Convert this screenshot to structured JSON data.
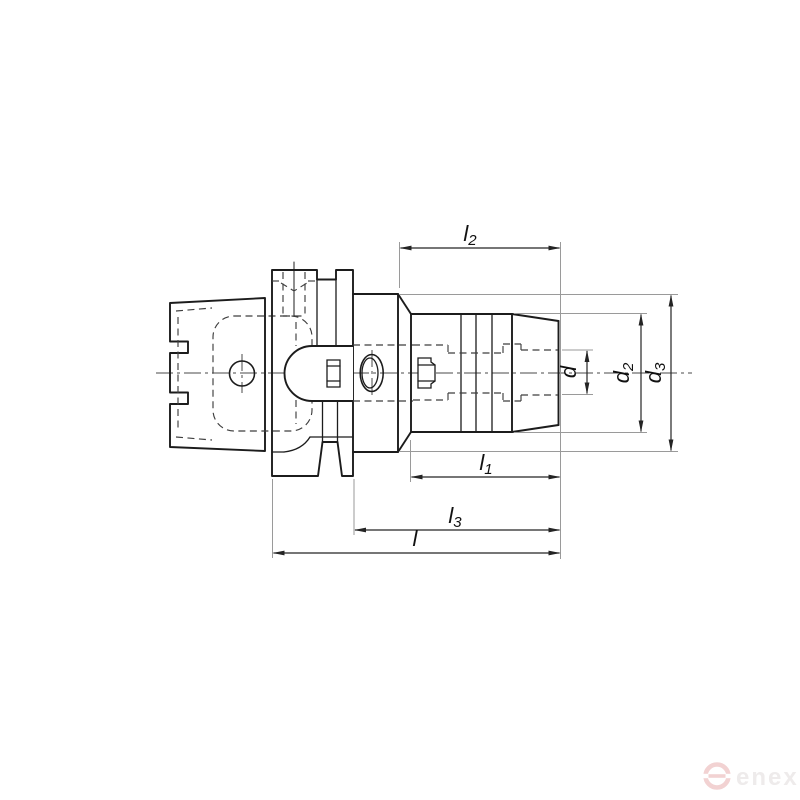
{
  "figure": {
    "description": "Technical line drawing of an HSK-shank chuck tool holder, side view with hidden-line section details",
    "view": "side-section"
  },
  "dimensions": {
    "l2": {
      "base": "l",
      "sub": "2"
    },
    "d": {
      "base": "d",
      "sub": ""
    },
    "d2": {
      "base": "d",
      "sub": "2"
    },
    "d3": {
      "base": "d",
      "sub": "3"
    },
    "l1": {
      "base": "l",
      "sub": "1"
    },
    "l3": {
      "base": "l",
      "sub": "3"
    },
    "l": {
      "base": "l",
      "sub": ""
    }
  },
  "watermark": {
    "text": "enex"
  },
  "colors": {
    "background": "#ffffff",
    "part_line": "#1c1c1c",
    "hidden_line": "#3f3f3f",
    "dimension_line": "#242424",
    "extension_line": "#9a9a9a",
    "label_text": "#111111",
    "watermark_logo": "#f2d2d2",
    "watermark_text": "#eeebeb"
  }
}
